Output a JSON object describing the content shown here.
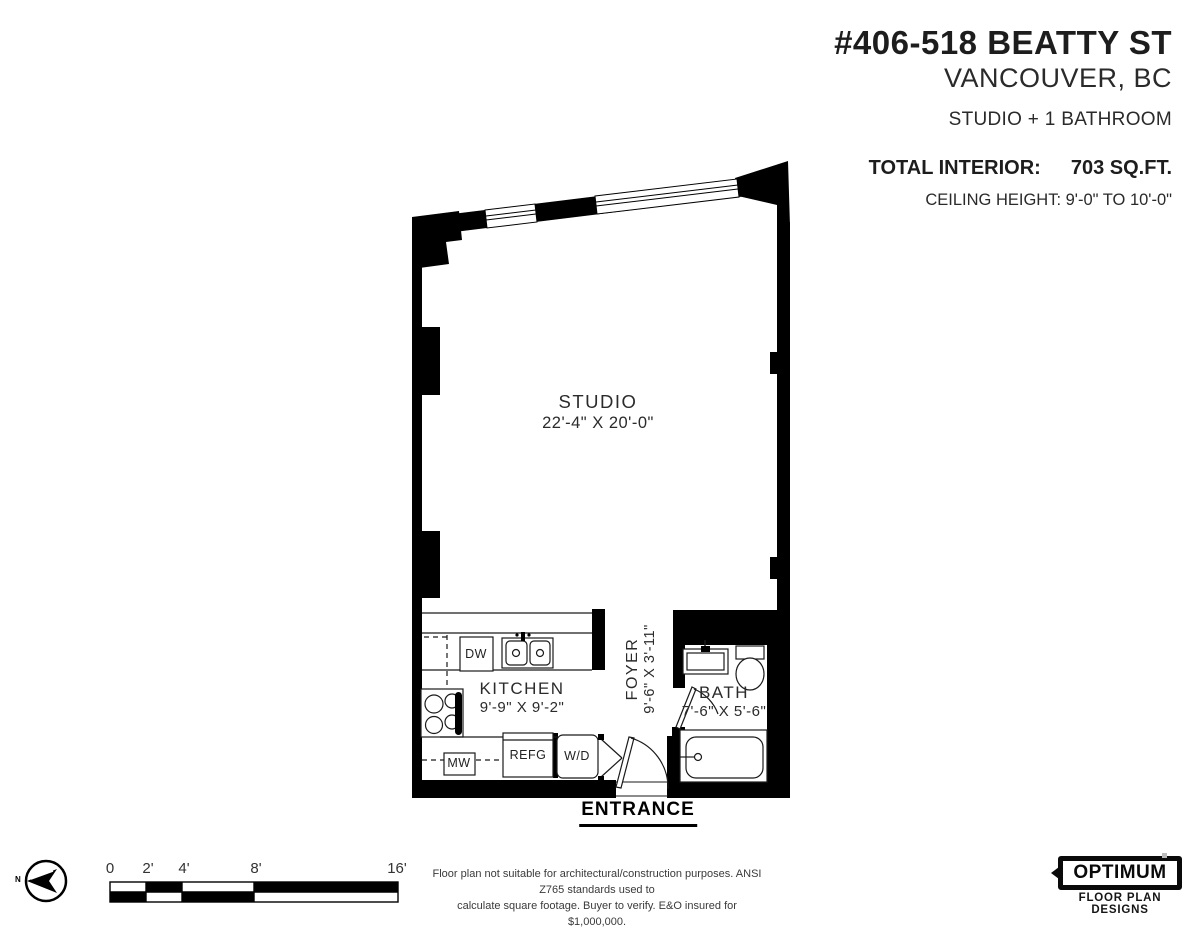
{
  "title_block": {
    "address": "#406-518 BEATTY ST",
    "city": "VANCOUVER, BC",
    "unit_type": "STUDIO + 1 BATHROOM",
    "total_interior_label": "TOTAL INTERIOR:",
    "total_interior_value": "703 SQ.FT.",
    "ceiling_height": "CEILING HEIGHT: 9'-0\" TO 10'-0\""
  },
  "rooms": {
    "studio": {
      "name": "STUDIO",
      "dims": "22'-4\" X 20'-0\""
    },
    "kitchen": {
      "name": "KITCHEN",
      "dims": "9'-9\" X 9'-2\""
    },
    "foyer": {
      "name": "FOYER",
      "dims": "9'-6\" X 3'-11\""
    },
    "bath": {
      "name": "BATH",
      "dims": "7'-6\" X 5'-6\""
    }
  },
  "fixtures": {
    "dishwasher": "DW",
    "microwave": "MW",
    "refrigerator": "REFG",
    "washer_dryer": "W/D"
  },
  "entrance_label": "ENTRANCE",
  "compass": {
    "north_label": "N"
  },
  "scale_bar": {
    "labels": [
      "0",
      "2'",
      "4'",
      "8'",
      "16'"
    ]
  },
  "footer": {
    "disclaimer_line1": "Floor plan not suitable for architectural/construction purposes. ANSI Z765 standards used to",
    "disclaimer_line2": "calculate square footage. Buyer to verify.  E&O insured for $1,000,000.",
    "logo_name": "OPTIMUM",
    "logo_subtitle": "FLOOR PLAN DESIGNS"
  },
  "colors": {
    "wall": "#000000",
    "line": "#1a1a1a",
    "text": "#231f20"
  }
}
